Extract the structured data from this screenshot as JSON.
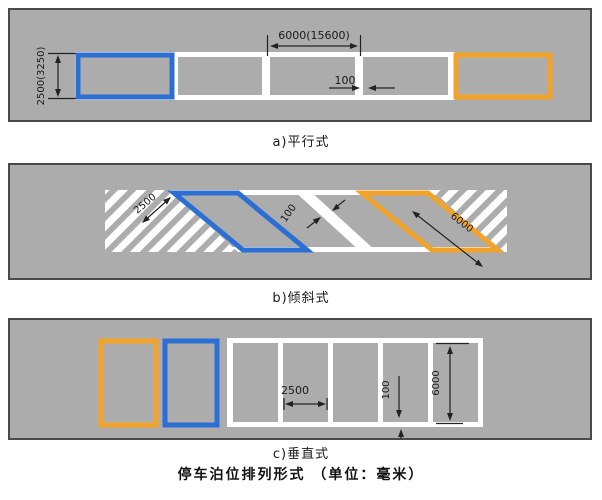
{
  "figure_title": "停车泊位排列形式 （单位：毫米）",
  "colors": {
    "stall_blue": "#2b6fd4",
    "stall_orange": "#f2a32a",
    "pavement_gray": "#acacac",
    "marking_white": "#ffffff",
    "panel_border": "#4a4a4a",
    "dim_line": "#222222"
  },
  "panel_a": {
    "caption": "a)平行式",
    "dim_length": "6000(15600)",
    "dim_line_width": "100",
    "dim_depth": "2500(3250)"
  },
  "panel_b": {
    "caption": "b)倾斜式",
    "dim_depth": "2500",
    "dim_line_width": "100",
    "dim_length": "6000"
  },
  "panel_c": {
    "caption": "c)垂直式",
    "dim_width": "2500",
    "dim_line_width": "100",
    "dim_depth": "6000"
  }
}
